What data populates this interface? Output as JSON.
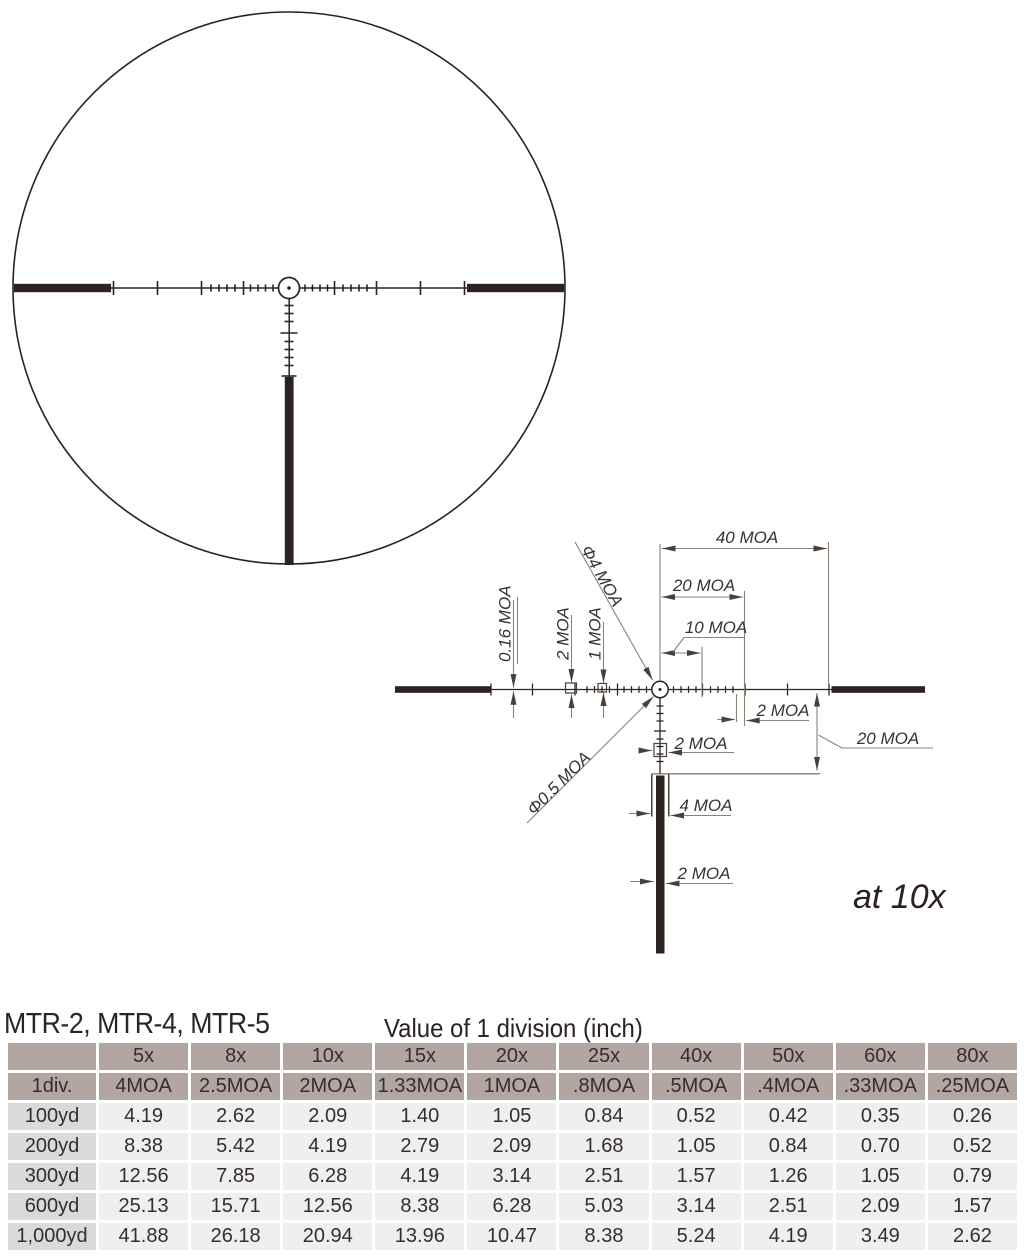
{
  "header": {
    "models": "MTR-2, MTR-4, MTR-5"
  },
  "diagram": {
    "note": "at 10x",
    "labels": {
      "dim40": "40 MOA",
      "dim20_top": "20 MOA",
      "dim10": "10 MOA",
      "dia4": "Φ4 MOA",
      "dia05": "Φ0.5 MOA",
      "dim016": "0.16 MOA",
      "dim2_left": "2 MOA",
      "dim1_left": "1 MOA",
      "dim2_right": "2 MOA",
      "dim20_right": "20 MOA",
      "dim2_below": "2 MOA",
      "dim4_post": "4 MOA",
      "dim2_post": "2 MOA"
    }
  },
  "table": {
    "caption": "Value of 1 division (inch)",
    "magnifications": [
      "5x",
      "8x",
      "10x",
      "15x",
      "20x",
      "25x",
      "40x",
      "50x",
      "60x",
      "80x"
    ],
    "div_row": {
      "label": "1div.",
      "values": [
        "4MOA",
        "2.5MOA",
        "2MOA",
        "1.33MOA",
        "1MOA",
        ".8MOA",
        ".5MOA",
        ".4MOA",
        ".33MOA",
        ".25MOA"
      ]
    },
    "range_rows": [
      {
        "label": "100yd",
        "values": [
          "4.19",
          "2.62",
          "2.09",
          "1.40",
          "1.05",
          "0.84",
          "0.52",
          "0.42",
          "0.35",
          "0.26"
        ]
      },
      {
        "label": "200yd",
        "values": [
          "8.38",
          "5.42",
          "4.19",
          "2.79",
          "2.09",
          "1.68",
          "1.05",
          "0.84",
          "0.70",
          "0.52"
        ]
      },
      {
        "label": "300yd",
        "values": [
          "12.56",
          "7.85",
          "6.28",
          "4.19",
          "3.14",
          "2.51",
          "1.57",
          "1.26",
          "1.05",
          "0.79"
        ]
      },
      {
        "label": "600yd",
        "values": [
          "25.13",
          "15.71",
          "12.56",
          "8.38",
          "6.28",
          "5.03",
          "3.14",
          "2.51",
          "2.09",
          "1.57"
        ]
      },
      {
        "label": "1,000yd",
        "values": [
          "41.88",
          "26.18",
          "20.94",
          "13.96",
          "10.47",
          "8.38",
          "5.24",
          "4.19",
          "3.49",
          "2.62"
        ]
      }
    ]
  },
  "colors": {
    "reticle_ink": "#2c221f",
    "dimension_line": "#8a8278",
    "arrowhead": "#4a4038",
    "label_text": "#3a322e",
    "table_header_bg": "#b1a7a0",
    "table_rowlabel_bg": "#dbdada",
    "table_cell_bg": "#f0eff0",
    "table_text": "#352d2f"
  }
}
